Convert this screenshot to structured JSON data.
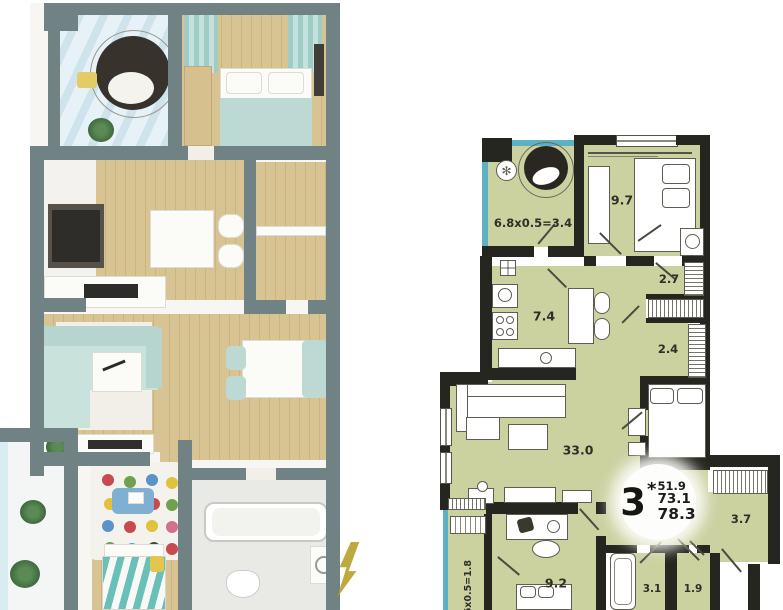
{
  "plan2d": {
    "labels": {
      "balcony_top": "6.8x0.5=3.4",
      "bedroom": "9.7",
      "closet_upper": "2.7",
      "closet_lower": "2.4",
      "kitchen": "7.4",
      "living_room": "33.0",
      "hallway": "3.7",
      "study": "9.2",
      "bathroom": "3.1",
      "wc": "1.9",
      "balcony_left": ".6x0.5=1.8"
    },
    "badge": {
      "room_count": "3",
      "asterisk": "*",
      "living_area": "51.9",
      "apartment_area": "73.1",
      "total_area": "78.3"
    },
    "icons": {
      "flower": "✻"
    },
    "colors": {
      "room_fill": "#ccd1a0",
      "wall": "#262620",
      "glazing": "#5cb2c4"
    }
  },
  "plan3d": {
    "colors": {
      "wall": "#708284",
      "wood_floor": "#d8c492",
      "mint_accent": "#bcd9d3",
      "glass": "#dff0f6",
      "watermark_gold": "#b3991f"
    }
  }
}
